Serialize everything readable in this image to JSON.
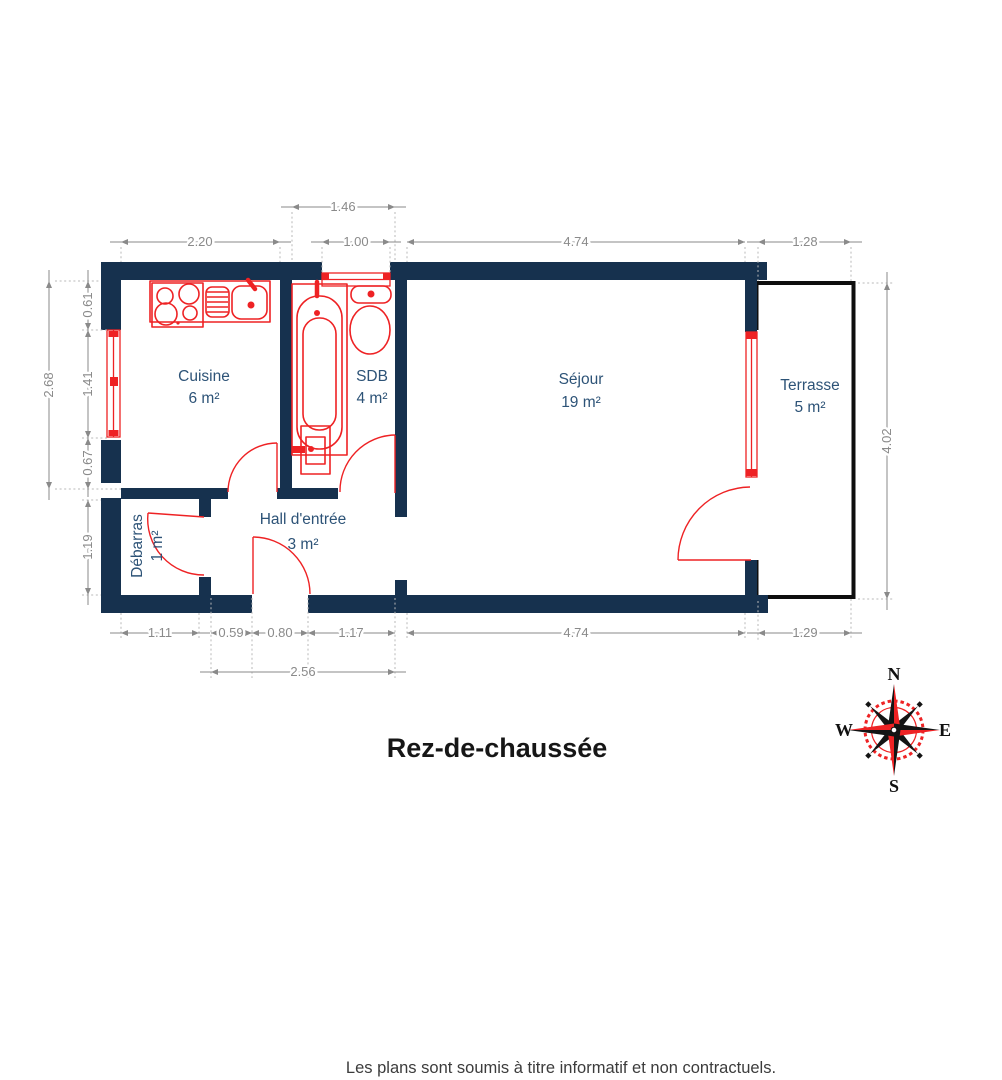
{
  "title": "Rez-de-chaussée",
  "footer": "Les plans sont soumis à titre informatif et non contractuels.",
  "compass": {
    "north": "N",
    "east": "E",
    "south": "S",
    "west": "W"
  },
  "rooms": {
    "cuisine": {
      "name": "Cuisine",
      "area": "6 m²"
    },
    "sdb": {
      "name": "SDB",
      "area": "4 m²"
    },
    "sejour": {
      "name": "Séjour",
      "area": "19 m²"
    },
    "terrasse": {
      "name": "Terrasse",
      "area": "5 m²"
    },
    "hall": {
      "name": "Hall d'entrée",
      "area": "3 m²"
    },
    "debarras": {
      "name": "Débarras",
      "area": "1 m²"
    }
  },
  "dimensions": {
    "top": {
      "cuisine": "2.20",
      "sdb_total": "1.46",
      "sdb_window": "1.00",
      "sejour": "4.74",
      "terrasse": "1.28"
    },
    "left": {
      "total": "2.68",
      "upper": "0.61",
      "window": "1.41",
      "lower": "0.67",
      "debarras": "1.19"
    },
    "right": {
      "terrasse": "4.02"
    },
    "bottom": {
      "debarras": "1.11",
      "hall_left": "0.59",
      "door": "0.80",
      "hall_right": "1.17",
      "sejour": "4.74",
      "terrasse": "1.29",
      "hall_total": "2.56"
    }
  },
  "colors": {
    "wall": "#16314e",
    "fixture": "#ee2224",
    "label": "#2d5377",
    "dim": "#8a8a8a",
    "outline": "#0e0e0e"
  }
}
